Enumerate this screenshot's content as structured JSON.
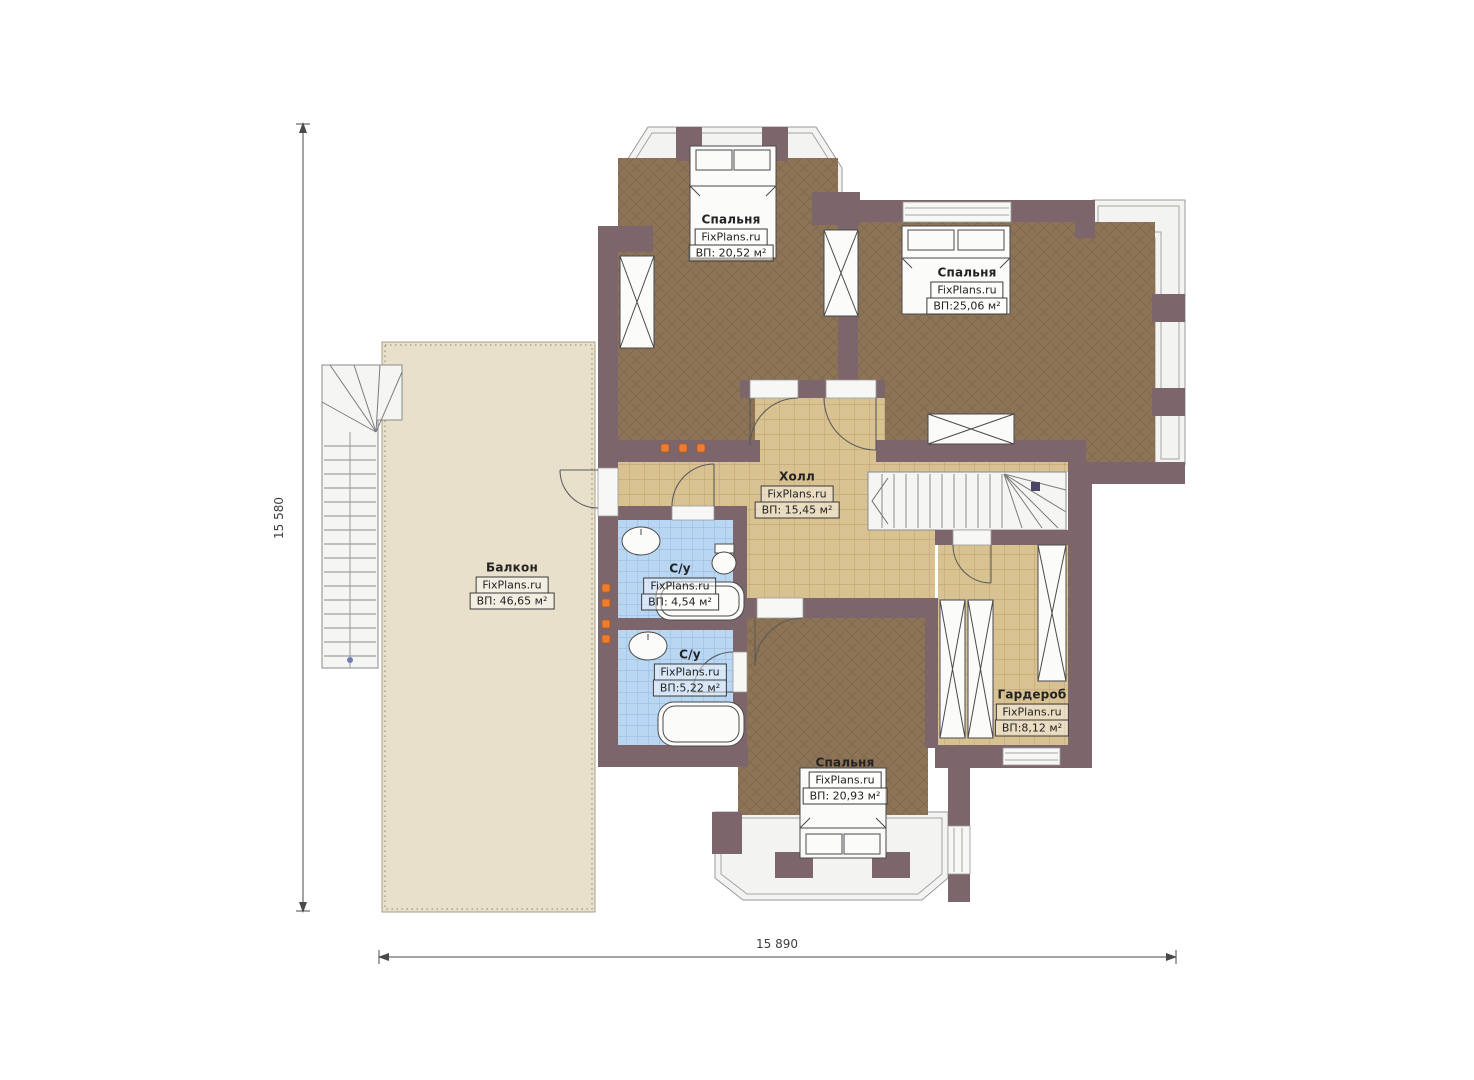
{
  "plan": {
    "rooms": [
      {
        "id": "bedroom-top-left",
        "name": "Спальня",
        "watermark": "FixPlans.ru",
        "area": "ВП: 20,52 м²"
      },
      {
        "id": "bedroom-top-right",
        "name": "Спальня",
        "watermark": "FixPlans.ru",
        "area": "ВП:25,06 м²"
      },
      {
        "id": "hall",
        "name": "Холл",
        "watermark": "FixPlans.ru",
        "area": "ВП: 15,45 м²"
      },
      {
        "id": "balcony",
        "name": "Балкон",
        "watermark": "FixPlans.ru",
        "area": "ВП: 46,65 м²"
      },
      {
        "id": "bathroom-upper",
        "name": "С/у",
        "watermark": "FixPlans.ru",
        "area": "ВП: 4,54 м²"
      },
      {
        "id": "bathroom-lower",
        "name": "С/у",
        "watermark": "FixPlans.ru",
        "area": "ВП:5,22 м²"
      },
      {
        "id": "wardrobe",
        "name": "Гардероб",
        "watermark": "FixPlans.ru",
        "area": "ВП:8,12 м²"
      },
      {
        "id": "bedroom-bottom",
        "name": "Спальня",
        "watermark": "FixPlans.ru",
        "area": "ВП: 20,93 м²"
      }
    ],
    "dimensions": {
      "height_label": "15 580",
      "width_label": "15 890"
    },
    "colors": {
      "wall": "#7c666c",
      "bedroom_floor": "#8d7456",
      "tile_floor": "#d9c291",
      "bath_floor": "#b9d6f2",
      "balcony_floor": "#e9e0cb",
      "bay_floor": "#f3f3f1",
      "radiator": "#ee7d2f"
    }
  }
}
